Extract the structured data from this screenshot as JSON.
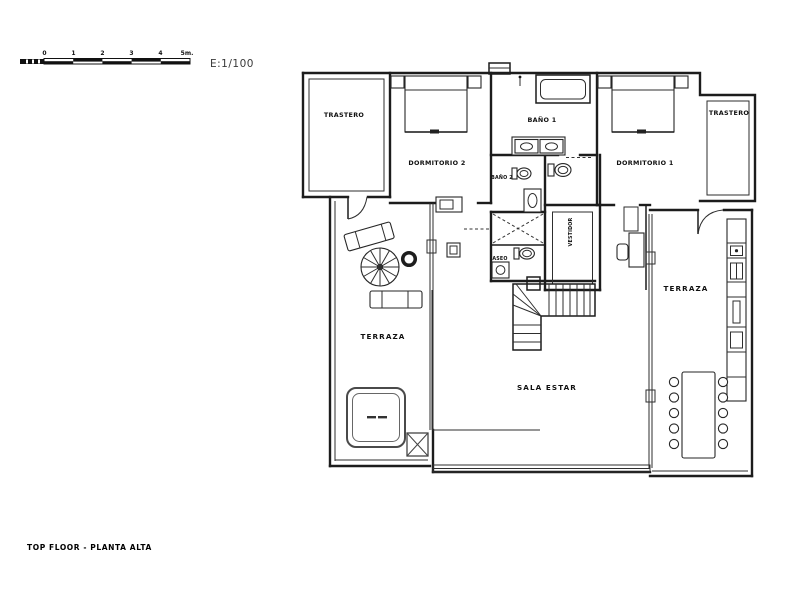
{
  "scale_bar": {
    "ticks": [
      "0",
      "1",
      "2",
      "3",
      "4"
    ],
    "end_label": "5m.",
    "ratio_label": "E:1/100"
  },
  "rooms": {
    "trastero_left": {
      "label": "TRASTERO"
    },
    "dormitorio_2": {
      "label": "DORMITORIO 2"
    },
    "bano_1": {
      "label": "BAÑO 1"
    },
    "bano_2": {
      "label": "BAÑO 2"
    },
    "aseo": {
      "label": "ASEO"
    },
    "vestidor": {
      "label": "VESTIDOR"
    },
    "dormitorio_1": {
      "label": "DORMITORIO 1"
    },
    "trastero_right": {
      "label": "TRASTERO"
    },
    "terraza_left": {
      "label": "TERRAZA"
    },
    "terraza_right": {
      "label": "TERRAZA"
    },
    "sala_estar": {
      "label": "SALA ESTAR"
    }
  },
  "footer": {
    "caption": "TOP FLOOR - PLANTA ALTA"
  },
  "colors": {
    "ink": "#1c1c1c",
    "background": "#ffffff"
  }
}
